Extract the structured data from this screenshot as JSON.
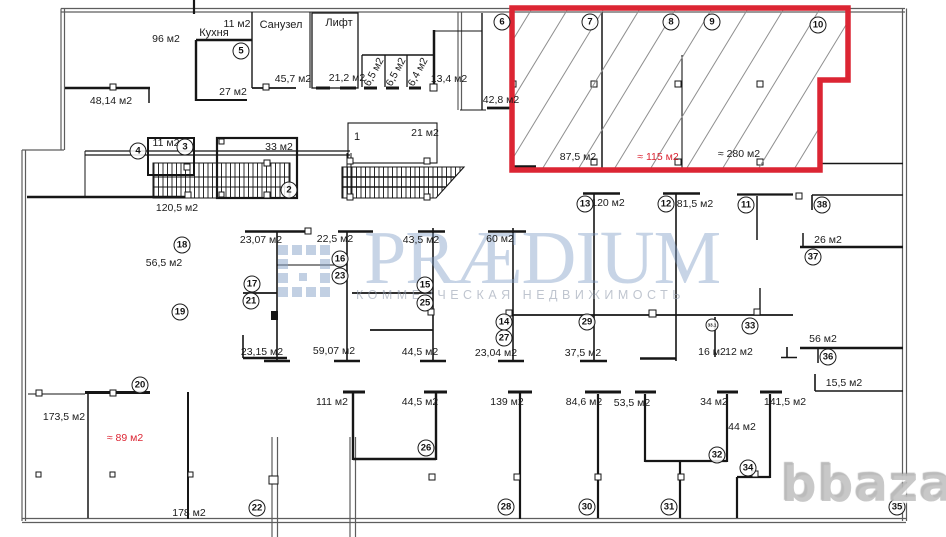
{
  "watermark": {
    "brand": "PRÆDIUM",
    "tagline": "КОММЕРЧЕСКАЯ НЕДВИЖИМОСТЬ",
    "photo_credit": "bbaza"
  },
  "highlight": {
    "color": "#dc2533",
    "approx_area_label": "≈ 115 м2"
  },
  "labels": [
    {
      "text": "96 м2",
      "x": 166,
      "y": 39
    },
    {
      "text": "11 м2",
      "x": 237,
      "y": 24
    },
    {
      "text": "Кухня",
      "x": 214,
      "y": 33,
      "name": true
    },
    {
      "text": "27 м2",
      "x": 233,
      "y": 92
    },
    {
      "text": "Санузел",
      "x": 281,
      "y": 25,
      "name": true
    },
    {
      "text": "45,7 м2",
      "x": 293,
      "y": 79
    },
    {
      "text": "Лифт",
      "x": 339,
      "y": 23,
      "name": true
    },
    {
      "text": "21,2 м2",
      "x": 347,
      "y": 78
    },
    {
      "text": "6,5 м2",
      "x": 374,
      "y": 72,
      "rot": true
    },
    {
      "text": "6,5 м2",
      "x": 396,
      "y": 72,
      "rot": true
    },
    {
      "text": "6,4 м2",
      "x": 418,
      "y": 72,
      "rot": true
    },
    {
      "text": "13,4 м2",
      "x": 449,
      "y": 79
    },
    {
      "text": "48,14 м2",
      "x": 111,
      "y": 101
    },
    {
      "text": "42,8 м2",
      "x": 501,
      "y": 100
    },
    {
      "text": "87,5 м2",
      "x": 578,
      "y": 157
    },
    {
      "text": "≈ 115 м2",
      "x": 658,
      "y": 157,
      "red": true
    },
    {
      "text": "≈ 280 м2",
      "x": 739,
      "y": 154
    },
    {
      "text": "11 м2",
      "x": 166,
      "y": 143
    },
    {
      "text": "33 м2",
      "x": 279,
      "y": 147
    },
    {
      "text": "1",
      "x": 357,
      "y": 137,
      "name": true
    },
    {
      "text": "21 м2",
      "x": 425,
      "y": 133
    },
    {
      "text": "120,5 м2",
      "x": 177,
      "y": 208
    },
    {
      "text": "56,5 м2",
      "x": 164,
      "y": 263
    },
    {
      "text": "23,07 м2",
      "x": 261,
      "y": 240
    },
    {
      "text": "22,5 м2",
      "x": 335,
      "y": 239
    },
    {
      "text": "43,5 м2",
      "x": 421,
      "y": 240
    },
    {
      "text": "60 м2",
      "x": 500,
      "y": 239
    },
    {
      "text": "120 м2",
      "x": 608,
      "y": 203
    },
    {
      "text": "81,5 м2",
      "x": 695,
      "y": 204
    },
    {
      "text": "26 м2",
      "x": 828,
      "y": 240
    },
    {
      "text": "23,15 м2",
      "x": 262,
      "y": 352
    },
    {
      "text": "59,07 м2",
      "x": 334,
      "y": 351
    },
    {
      "text": "44,5 м2",
      "x": 420,
      "y": 352
    },
    {
      "text": "23,04 м2",
      "x": 496,
      "y": 353
    },
    {
      "text": "37,5 м2",
      "x": 583,
      "y": 353
    },
    {
      "text": "16 м2",
      "x": 712,
      "y": 352
    },
    {
      "text": "12 м2",
      "x": 739,
      "y": 352
    },
    {
      "text": "56 м2",
      "x": 823,
      "y": 339
    },
    {
      "text": "15,5 м2",
      "x": 844,
      "y": 383
    },
    {
      "text": "173,5 м2",
      "x": 64,
      "y": 417
    },
    {
      "text": "≈ 89 м2",
      "x": 125,
      "y": 438,
      "red": true
    },
    {
      "text": "178 м2",
      "x": 189,
      "y": 513
    },
    {
      "text": "111 м2",
      "x": 332,
      "y": 402
    },
    {
      "text": "44,5 м2",
      "x": 420,
      "y": 402
    },
    {
      "text": "139 м2",
      "x": 507,
      "y": 402
    },
    {
      "text": "84,6 м2",
      "x": 584,
      "y": 402
    },
    {
      "text": "53,5 м2",
      "x": 632,
      "y": 403
    },
    {
      "text": "34 м2",
      "x": 714,
      "y": 402
    },
    {
      "text": "44 м2",
      "x": 742,
      "y": 427
    },
    {
      "text": "141,5 м2",
      "x": 785,
      "y": 402
    }
  ],
  "badges": [
    {
      "n": "2",
      "x": 289,
      "y": 190
    },
    {
      "n": "3",
      "x": 185,
      "y": 147
    },
    {
      "n": "4",
      "x": 138,
      "y": 151
    },
    {
      "n": "5",
      "x": 241,
      "y": 51
    },
    {
      "n": "6",
      "x": 502,
      "y": 22
    },
    {
      "n": "7",
      "x": 590,
      "y": 22
    },
    {
      "n": "8",
      "x": 671,
      "y": 22
    },
    {
      "n": "9",
      "x": 712,
      "y": 22
    },
    {
      "n": "10",
      "x": 818,
      "y": 25
    },
    {
      "n": "11",
      "x": 746,
      "y": 205
    },
    {
      "n": "12",
      "x": 666,
      "y": 204
    },
    {
      "n": "13",
      "x": 585,
      "y": 204
    },
    {
      "n": "14",
      "x": 504,
      "y": 322
    },
    {
      "n": "15",
      "x": 425,
      "y": 285
    },
    {
      "n": "16",
      "x": 340,
      "y": 259
    },
    {
      "n": "17",
      "x": 252,
      "y": 284
    },
    {
      "n": "18",
      "x": 182,
      "y": 245
    },
    {
      "n": "19",
      "x": 180,
      "y": 312
    },
    {
      "n": "20",
      "x": 140,
      "y": 385
    },
    {
      "n": "21",
      "x": 251,
      "y": 301
    },
    {
      "n": "22",
      "x": 257,
      "y": 508
    },
    {
      "n": "23",
      "x": 340,
      "y": 276
    },
    {
      "n": "25",
      "x": 425,
      "y": 303
    },
    {
      "n": "26",
      "x": 426,
      "y": 448
    },
    {
      "n": "27",
      "x": 504,
      "y": 338
    },
    {
      "n": "28",
      "x": 506,
      "y": 507
    },
    {
      "n": "29",
      "x": 587,
      "y": 322
    },
    {
      "n": "30",
      "x": 587,
      "y": 507
    },
    {
      "n": "31",
      "x": 669,
      "y": 507
    },
    {
      "n": "32",
      "x": 717,
      "y": 455
    },
    {
      "n": "33",
      "x": 750,
      "y": 326
    },
    {
      "n": "33.1",
      "x": 712,
      "y": 325,
      "small": true
    },
    {
      "n": "34",
      "x": 748,
      "y": 468
    },
    {
      "n": "35",
      "x": 897,
      "y": 507
    },
    {
      "n": "36",
      "x": 828,
      "y": 357
    },
    {
      "n": "37",
      "x": 813,
      "y": 257
    },
    {
      "n": "38",
      "x": 822,
      "y": 205
    }
  ]
}
